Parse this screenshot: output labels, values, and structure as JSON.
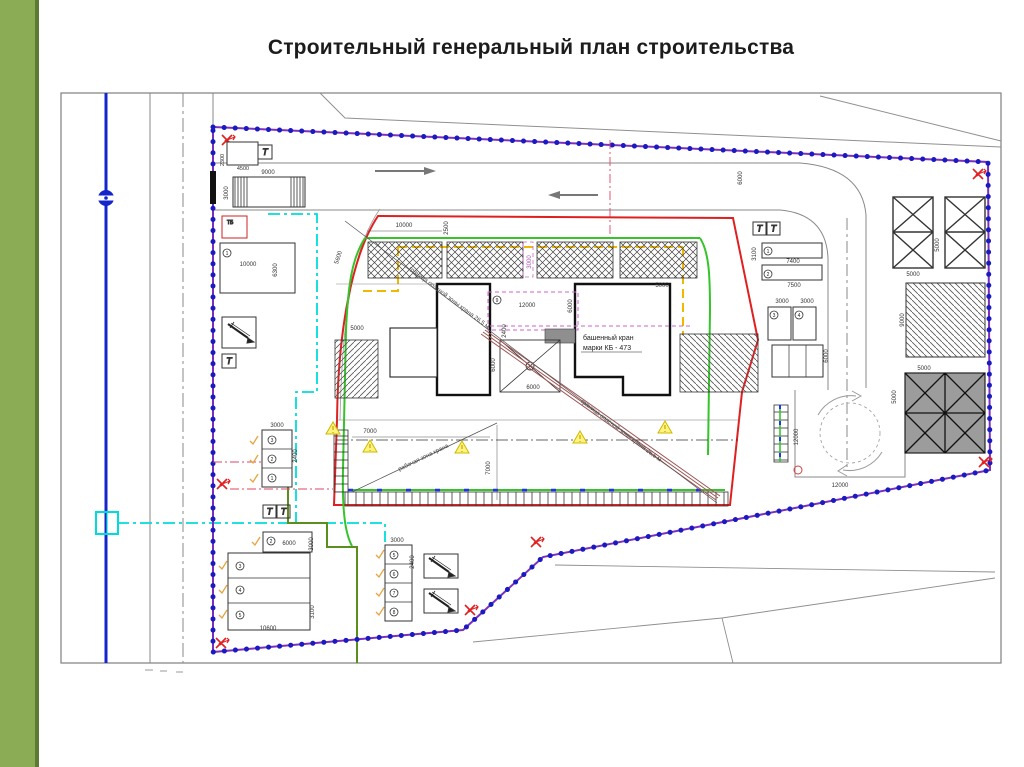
{
  "slide": {
    "title": "Строительный генеральный план строительства"
  },
  "plan": {
    "crane_label_line1": "башенный кран",
    "crane_label_line2": "марки КБ - 473",
    "diag_label_1": "граница опасной зоны крана 26,5 м",
    "diag_label_2": "граница опасной зоны крана 26,5 м",
    "diag_label_3": "рабочая зона крана",
    "tb_label": "ТБ",
    "t_label": "Т"
  },
  "colors": {
    "sidebar_green": "#8cab55",
    "sidebar_edge": "#5e7a33",
    "fence_blue": "#1a1ac0",
    "fence_violet": "#7b2fbf",
    "danger_red": "#e02020",
    "zone_green": "#35c42a",
    "utility_green": "#5a8f1e",
    "temp_yellow": "#f0b800",
    "water_cyan": "#00dcdc",
    "axis_pink": "#cc66cc",
    "road_gray": "#8a8a8a",
    "water_line_blue": "#1525cc"
  },
  "labels": [
    {
      "t": "9000",
      "x": 268,
      "y": 174,
      "r": 0
    },
    {
      "t": "3000",
      "x": 228,
      "y": 193,
      "r": -90
    },
    {
      "t": "4500",
      "x": 243,
      "y": 170,
      "r": 0,
      "c": "dim-sm"
    },
    {
      "t": "2300",
      "x": 224,
      "y": 160,
      "r": -90,
      "c": "dim-sm"
    },
    {
      "t": "10000",
      "x": 248,
      "y": 266,
      "r": 0
    },
    {
      "t": "6300",
      "x": 277,
      "y": 270,
      "r": -90
    },
    {
      "t": "10000",
      "x": 404,
      "y": 227,
      "r": 0
    },
    {
      "t": "2500",
      "x": 448,
      "y": 228,
      "r": -90
    },
    {
      "t": "3000",
      "x": 531,
      "y": 262,
      "r": -90,
      "c": "dim-pink"
    },
    {
      "t": "5600",
      "x": 340,
      "y": 258,
      "r": -72
    },
    {
      "t": "5000",
      "x": 357,
      "y": 330,
      "r": 0
    },
    {
      "t": "12000",
      "x": 527,
      "y": 307,
      "r": 0
    },
    {
      "t": "6000",
      "x": 572,
      "y": 306,
      "r": -90
    },
    {
      "t": "2400",
      "x": 506,
      "y": 331,
      "r": -90
    },
    {
      "t": "5000",
      "x": 662,
      "y": 287,
      "r": 0
    },
    {
      "t": "6000",
      "x": 495,
      "y": 365,
      "r": -90
    },
    {
      "t": "6000",
      "x": 533,
      "y": 389,
      "r": 0
    },
    {
      "t": "7000",
      "x": 370,
      "y": 433,
      "r": 0
    },
    {
      "t": "7000",
      "x": 490,
      "y": 468,
      "r": -90
    },
    {
      "t": "3000",
      "x": 277,
      "y": 427,
      "r": 0
    },
    {
      "t": "2400",
      "x": 297,
      "y": 456,
      "r": -90
    },
    {
      "t": "6000",
      "x": 289,
      "y": 545,
      "r": 0
    },
    {
      "t": "3000",
      "x": 313,
      "y": 544,
      "r": -90
    },
    {
      "t": "10600",
      "x": 268,
      "y": 630,
      "r": 0
    },
    {
      "t": "3100",
      "x": 314,
      "y": 612,
      "r": -90
    },
    {
      "t": "3000",
      "x": 397,
      "y": 542,
      "r": 0
    },
    {
      "t": "2400",
      "x": 414,
      "y": 562,
      "r": -90
    },
    {
      "t": "6000",
      "x": 742,
      "y": 178,
      "r": -90
    },
    {
      "t": "7400",
      "x": 793,
      "y": 263,
      "r": 0
    },
    {
      "t": "7500",
      "x": 794,
      "y": 287,
      "r": 0
    },
    {
      "t": "3100",
      "x": 756,
      "y": 254,
      "r": -90
    },
    {
      "t": "3000",
      "x": 782,
      "y": 303,
      "r": 0
    },
    {
      "t": "3000",
      "x": 807,
      "y": 303,
      "r": 0
    },
    {
      "t": "6000",
      "x": 828,
      "y": 356,
      "r": -90
    },
    {
      "t": "5000",
      "x": 913,
      "y": 276,
      "r": 0
    },
    {
      "t": "5000",
      "x": 939,
      "y": 245,
      "r": -90
    },
    {
      "t": "9000",
      "x": 904,
      "y": 320,
      "r": -90
    },
    {
      "t": "5000",
      "x": 924,
      "y": 370,
      "r": 0
    },
    {
      "t": "5000",
      "x": 896,
      "y": 397,
      "r": -90
    },
    {
      "t": "12000",
      "x": 840,
      "y": 487,
      "r": 0
    },
    {
      "t": "12000",
      "x": 798,
      "y": 437,
      "r": -90
    }
  ],
  "circled": [
    {
      "t": "1",
      "x": 227,
      "y": 253
    },
    {
      "t": "3",
      "x": 272,
      "y": 440
    },
    {
      "t": "2",
      "x": 272,
      "y": 459
    },
    {
      "t": "1",
      "x": 272,
      "y": 478
    },
    {
      "t": "2",
      "x": 271,
      "y": 541
    },
    {
      "t": "3",
      "x": 240,
      "y": 566
    },
    {
      "t": "4",
      "x": 240,
      "y": 590
    },
    {
      "t": "5",
      "x": 240,
      "y": 615
    },
    {
      "t": "5",
      "x": 394,
      "y": 555
    },
    {
      "t": "6",
      "x": 394,
      "y": 574
    },
    {
      "t": "7",
      "x": 394,
      "y": 593
    },
    {
      "t": "8",
      "x": 394,
      "y": 612
    },
    {
      "t": "1",
      "x": 768,
      "y": 251
    },
    {
      "t": "2",
      "x": 768,
      "y": 274
    },
    {
      "t": "3",
      "x": 774,
      "y": 315
    },
    {
      "t": "4",
      "x": 799,
      "y": 315
    },
    {
      "t": "9",
      "x": 497,
      "y": 300
    }
  ]
}
